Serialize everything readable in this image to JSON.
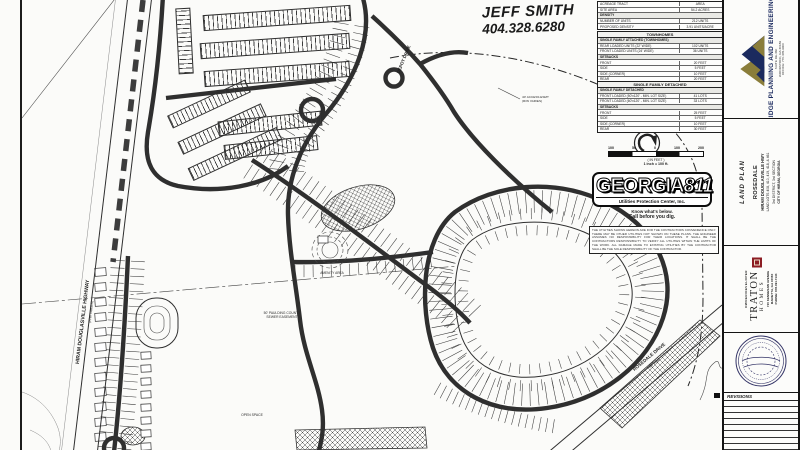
{
  "contact": {
    "name": "JEFF SMITH",
    "phone": "404.328.6280"
  },
  "site_table": {
    "rows": [
      [
        "ACREAGE TRACT",
        "AREA"
      ],
      [
        "SITE AREA",
        "54.2 ACRES"
      ],
      "DENSITY",
      [
        "NUMBER OF UNITS",
        "212 UNITS"
      ],
      [
        "PROPOSED DENSITY",
        "3.91 UNITS/ACRE"
      ]
    ]
  },
  "townhomes_table": {
    "title": "TOWNHOMES",
    "rows": [
      "SINGLE FAMILY ATTACHED (TOWNHOMES)",
      [
        "REAR LOADED UNITS (22' WIDE)",
        "102 UNITS"
      ],
      [
        "FRONT LOADED UNITS (24' WIDE)",
        "36 UNITS"
      ],
      "SETBACKS",
      [
        "FRONT",
        "20 FEET"
      ],
      [
        "SIDE",
        "5 FEET"
      ],
      [
        "SIDE (CORNER)",
        "10 FEET"
      ],
      [
        "REAR",
        "20 FEET"
      ]
    ]
  },
  "sfd_table": {
    "title": "SINGLE FAMILY DETACHED",
    "rows": [
      "SINGLE FAMILY DETACHED",
      [
        "FRONT LOADED (50'x120' - MIN. LOT SIZE)",
        "41 LOTS"
      ],
      [
        "FRONT LOADED (60'x120' - MIN. LOT SIZE)",
        "33 LOTS"
      ],
      "SETBACKS",
      [
        "FRONT",
        "25 FEET"
      ],
      [
        "SIDE",
        "5 FEET"
      ],
      [
        "SIDE (CORNER)",
        "10 FEET"
      ],
      [
        "REAR",
        "30 FEET"
      ]
    ]
  },
  "scalebar": {
    "ticks": [
      "100",
      "50",
      "0",
      "100",
      "200"
    ],
    "units_label": "( IN FEET )",
    "ratio_label": "1 inch = 100 ft."
  },
  "georgia811": {
    "name": "GEORGIA",
    "number": "811",
    "subtitle": "Utilities Protection Center, Inc.",
    "tagline_1": "Know what's below.",
    "tagline_2": "Call before you dig."
  },
  "disclaimer": "THE UTILITIES SHOWN HEREON ARE FOR THE CONTRACTORS CONVENIENCE ONLY. THERE MAY BE OTHER UTILITIES NOT SHOWN ON THESE PLANS. THE ENGINEER ASSUMES NO RESPONSIBILITY FOR THEIR LOCATIONS. IT SHALL BE THE CONTRACTORS RESPONSIBILITY TO VERIFY ALL UTILITIES WITHIN THE LIMITS OF THE WORK. ALL DAMAGE MADE TO EXISTING UTILITIES BY THE CONTRACTOR SHALL BE THE SOLE RESPONSIBILITY OF THE CONTRACTOR.",
  "map": {
    "labels": {
      "highway": "HIRAM DOUGLASVILLE HIGHWAY",
      "highway_sub": "(R/W VARIES)",
      "depot": "DEPOT DRIVE",
      "rosedale": "ROSEDALE DRIVE",
      "rosedale_sub": "(60' R/W)",
      "sewer_1": "50' PAULDING COUNTY",
      "sewer_2": "SEWER EASEMENT",
      "access_1": "40' ACCESS ESMT",
      "access_2": "(R/W VARIES)",
      "amenity": "AMENITY AREA",
      "open_space": "OPEN SPACE"
    }
  },
  "titleblock": {
    "firm": {
      "name": "RIDGE PLANNING AND ENGINEERING",
      "address_1": "SUITE DE-360",
      "address_2": "WOODSTOCK, GA 30189",
      "address_3": "OFFICE: 770.345.9000"
    },
    "sheet": {
      "type": "LAND PLAN",
      "project": "ROSEDALE",
      "road": "HIRAM DOUGLASVILLE HWY",
      "lots": "LAND LOTS 408, 410, 419, 418, & 461",
      "district": "3rd DISTRICT, 3rd SECTION",
      "city": "CITY OF HIRAM, GEORGIA"
    },
    "owner": {
      "label": "OWNER/DEVELOPER",
      "name_1": "TRATON",
      "name_2": "HOMES",
      "address_1": "720 KENNESAW AVENUE",
      "address_2": "MARIETTA, GA 30060",
      "address_3": "PHONE: 678.391.7134"
    },
    "revisions": {
      "title": "REVISIONS",
      "row_count": 8
    }
  }
}
